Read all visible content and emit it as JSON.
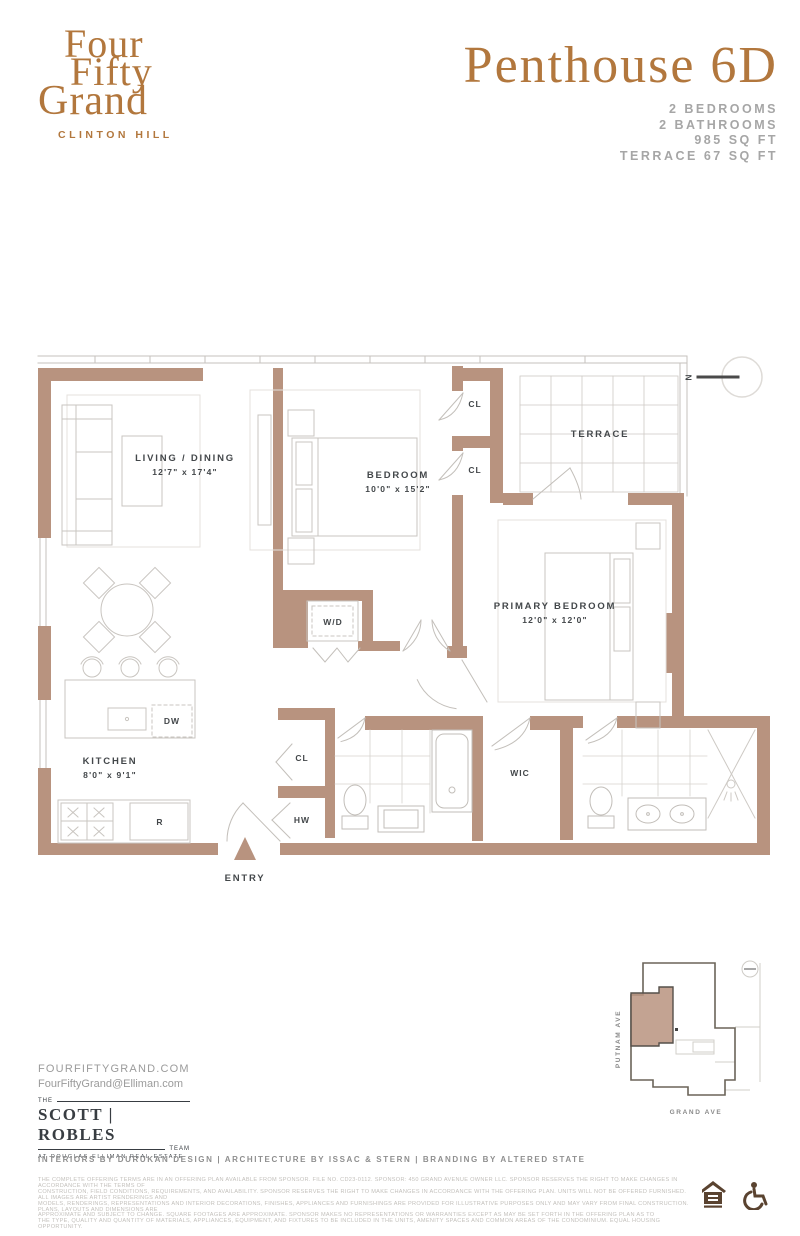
{
  "header": {
    "logo": {
      "line1": "Four",
      "line2": "Fifty",
      "line3": "Grand",
      "subtitle": "CLINTON HILL"
    },
    "title": "Penthouse 6D",
    "specs": [
      "2 BEDROOMS",
      "2 BATHROOMS",
      "985 SQ FT",
      "TERRACE 67 SQ FT"
    ]
  },
  "floorplan": {
    "rooms": {
      "living": {
        "name": "LIVING / DINING",
        "dims": "12'7\" x 17'4\""
      },
      "bedroom": {
        "name": "BEDROOM",
        "dims": "10'0\" x 15'2\""
      },
      "primary": {
        "name": "PRIMARY BEDROOM",
        "dims": "12'0\" x 12'0\""
      },
      "kitchen": {
        "name": "KITCHEN",
        "dims": "8'0\" x 9'1\""
      },
      "terrace": {
        "name": "TERRACE"
      }
    },
    "labels": {
      "wd": "W/D",
      "cl": "CL",
      "hw": "HW",
      "wic": "WIC",
      "dw": "DW",
      "refrigerator": "R",
      "entry": "ENTRY",
      "north": "N"
    }
  },
  "keyplan": {
    "street_left": "PUTNAM AVE",
    "street_bottom": "GRAND AVE"
  },
  "footer": {
    "website": "FOURFIFTYGRAND.COM",
    "email": "FourFiftyGrand@Elliman.com",
    "team": {
      "the": "THE",
      "name": "SCOTT | ROBLES",
      "team": "TEAM",
      "tagline": "AT DOUGLAS ELLIMAN REAL ESTATE"
    },
    "credits": "INTERIORS BY DURUKAN DESIGN | ARCHITECTURE BY ISSAC & STERN | BRANDING BY ALTERED STATE",
    "disclaimer": [
      "THE COMPLETE OFFERING TERMS ARE IN AN OFFERING PLAN AVAILABLE FROM SPONSOR. FILE NO. CD23-0112. SPONSOR: 450 GRAND AVENUE OWNER LLC. SPONSOR RESERVES THE RIGHT TO MAKE CHANGES IN ACCORDANCE WITH THE TERMS OF",
      "CONSTRUCTION, FIELD CONDITIONS, REQUIREMENTS, AND AVAILABILITY. SPONSOR RESERVES THE RIGHT TO MAKE CHANGES IN ACCORDANCE WITH THE OFFERING PLAN. UNITS WILL NOT BE OFFERED FURNISHED. ALL IMAGES ARE ARTIST RENDERINGS AND",
      "MODELS, RENDERINGS, REPRESENTATIONS AND INTERIOR DECORATIONS, FINISHES, APPLIANCES AND FURNISHINGS ARE PROVIDED FOR ILLUSTRATIVE PURPOSES ONLY AND MAY VARY FROM FINAL CONSTRUCTION. PLANS, LAYOUTS AND DIMENSIONS ARE",
      "APPROXIMATE AND SUBJECT TO CHANGE. SQUARE FOOTAGES ARE APPROXIMATE. SPONSOR MAKES NO REPRESENTATIONS OR WARRANTIES EXCEPT AS MAY BE SET FORTH IN THE OFFERING PLAN AS TO",
      "THE TYPE, QUALITY AND QUANTITY OF MATERIALS, APPLIANCES, EQUIPMENT, AND FIXTURES TO BE INCLUDED IN THE UNITS, AMENITY SPACES AND COMMON AREAS OF THE CONDOMINIUM. EQUAL HOUSING OPPORTUNITY."
    ]
  },
  "colors": {
    "copper": "#b2773d",
    "wall": "#b8937f",
    "label": "#43474a",
    "spec_gray": "#a6a6a6"
  }
}
